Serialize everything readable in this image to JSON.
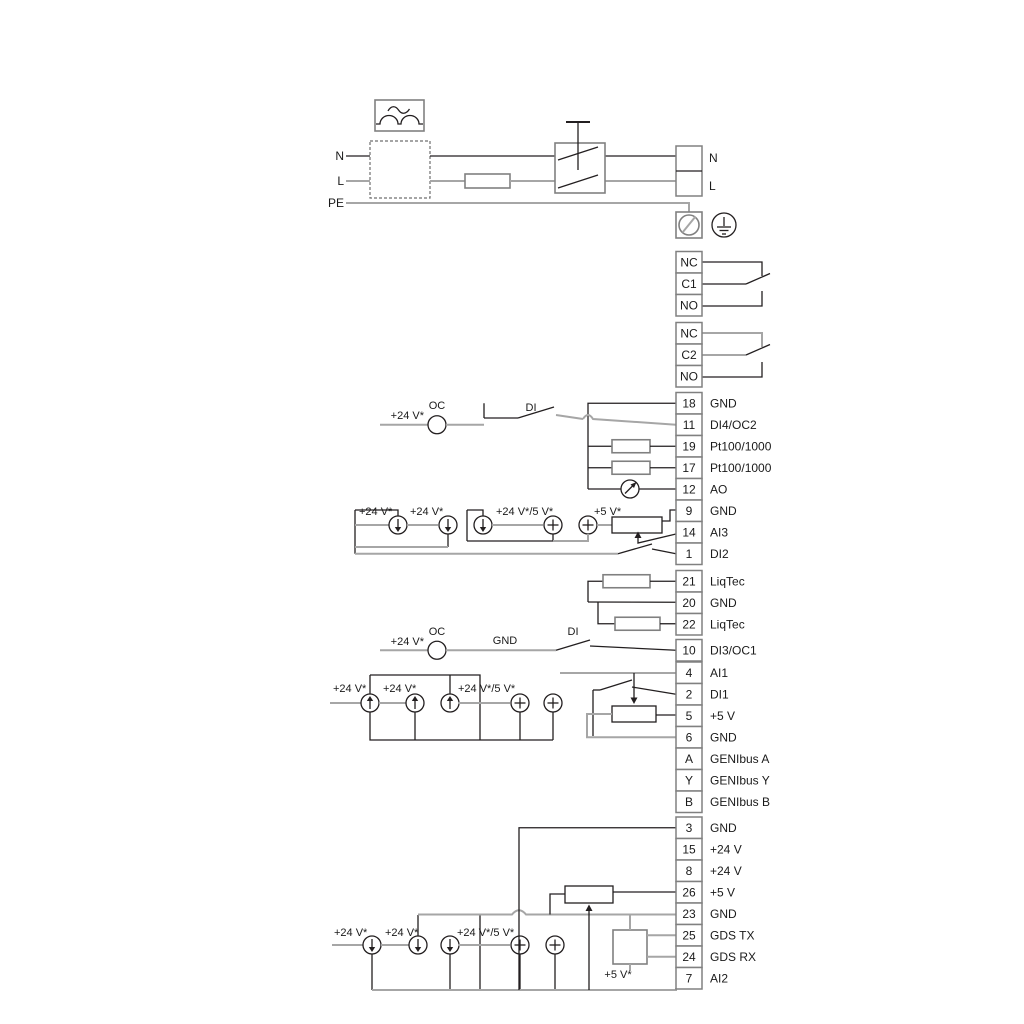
{
  "colors": {
    "wire_black": "#231f20",
    "wire_gray": "#a6a6a6",
    "box_border": "#808080",
    "text": "#1a1a1a",
    "background": "#ffffff"
  },
  "power": {
    "n_left": "N",
    "l_left": "L",
    "pe_left": "PE",
    "n_right": "N",
    "l_right": "L"
  },
  "terminal_groups": [
    {
      "key": "relay1",
      "terminals": [
        {
          "id": "NC"
        },
        {
          "id": "C1"
        },
        {
          "id": "NO"
        }
      ]
    },
    {
      "key": "relay2",
      "terminals": [
        {
          "id": "NC"
        },
        {
          "id": "C2"
        },
        {
          "id": "NO"
        }
      ]
    },
    {
      "key": "io_top",
      "terminals": [
        {
          "id": "18",
          "label": "GND"
        },
        {
          "id": "11",
          "label": "DI4/OC2"
        },
        {
          "id": "19",
          "label": "Pt100/1000"
        },
        {
          "id": "17",
          "label": "Pt100/1000"
        },
        {
          "id": "12",
          "label": "AO"
        },
        {
          "id": "9",
          "label": "GND"
        },
        {
          "id": "14",
          "label": "AI3"
        },
        {
          "id": "1",
          "label": "DI2"
        }
      ]
    },
    {
      "key": "liqtec",
      "terminals": [
        {
          "id": "21",
          "label": "LiqTec"
        },
        {
          "id": "20",
          "label": "GND"
        },
        {
          "id": "22",
          "label": "LiqTec"
        }
      ]
    },
    {
      "key": "di3",
      "terminals": [
        {
          "id": "10",
          "label": "DI3/OC1"
        }
      ]
    },
    {
      "key": "io_mid",
      "terminals": [
        {
          "id": "4",
          "label": "AI1"
        },
        {
          "id": "2",
          "label": "DI1"
        },
        {
          "id": "5",
          "label": "+5 V"
        },
        {
          "id": "6",
          "label": "GND"
        },
        {
          "id": "A",
          "label": "GENIbus A"
        },
        {
          "id": "Y",
          "label": "GENIbus Y"
        },
        {
          "id": "B",
          "label": "GENIbus B"
        }
      ]
    },
    {
      "key": "io_bottom",
      "terminals": [
        {
          "id": "3",
          "label": "GND"
        },
        {
          "id": "15",
          "label": "+24 V"
        },
        {
          "id": "8",
          "label": "+24 V"
        },
        {
          "id": "26",
          "label": "+5 V"
        },
        {
          "id": "23",
          "label": "GND"
        },
        {
          "id": "25",
          "label": "GDS TX"
        },
        {
          "id": "24",
          "label": "GDS RX"
        },
        {
          "id": "7",
          "label": "AI2"
        }
      ]
    }
  ],
  "annotations": [
    {
      "id": "t24a",
      "text": "+24 V*"
    },
    {
      "id": "oc1",
      "text": "OC"
    },
    {
      "id": "di1",
      "text": "DI"
    },
    {
      "id": "r1a",
      "text": "+24 V*"
    },
    {
      "id": "r1b",
      "text": "+24 V*"
    },
    {
      "id": "r1c",
      "text": "+24 V*/5 V*"
    },
    {
      "id": "r1d",
      "text": "+5 V*"
    },
    {
      "id": "t24b",
      "text": "+24 V*"
    },
    {
      "id": "oc2",
      "text": "OC"
    },
    {
      "id": "gnd1",
      "text": "GND"
    },
    {
      "id": "di2l",
      "text": "DI"
    },
    {
      "id": "r2a",
      "text": "+24 V*"
    },
    {
      "id": "r2b",
      "text": "+24 V*"
    },
    {
      "id": "r2c",
      "text": "+24 V*/5 V*"
    },
    {
      "id": "r3a",
      "text": "+24 V*"
    },
    {
      "id": "r3b",
      "text": "+24 V*"
    },
    {
      "id": "r3c",
      "text": "+24 V*/5 V*"
    },
    {
      "id": "r3d",
      "text": "+5 V*"
    }
  ]
}
